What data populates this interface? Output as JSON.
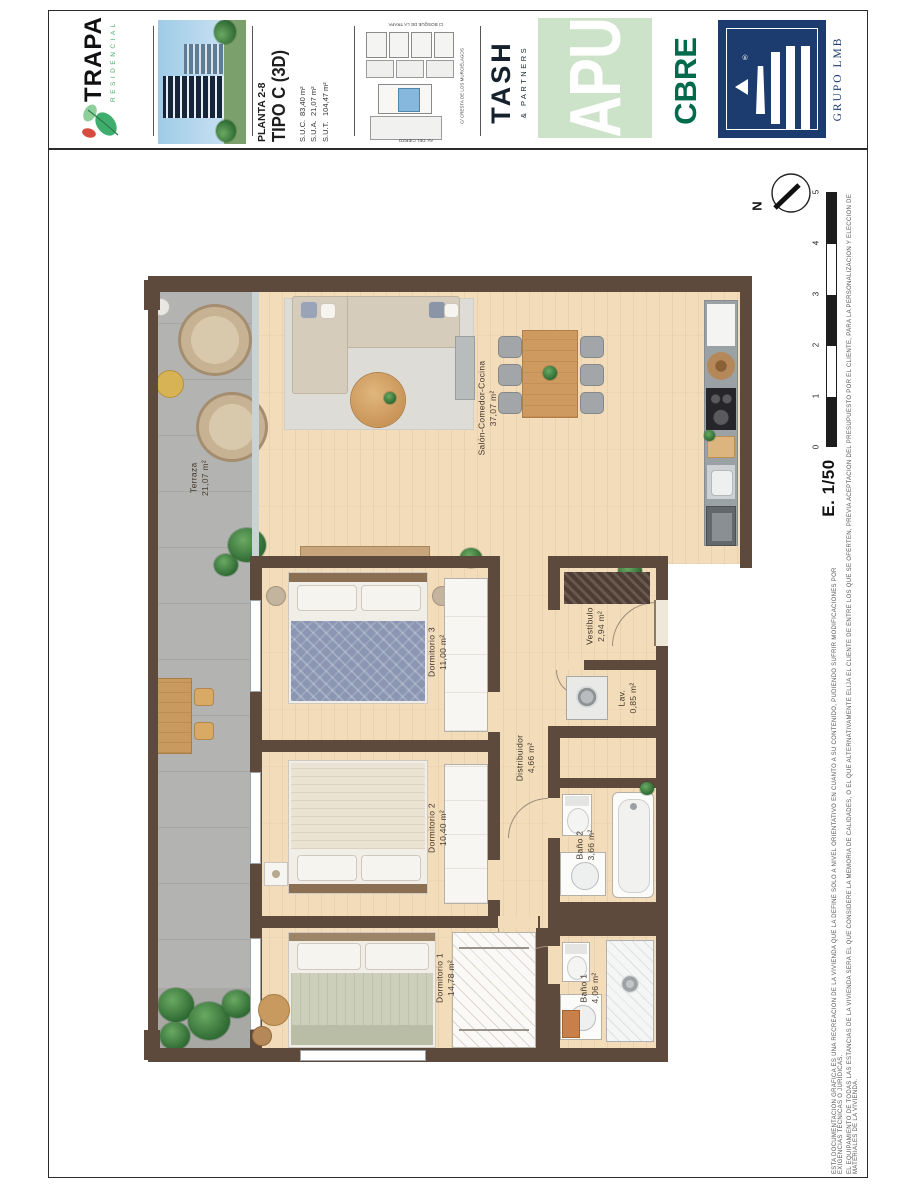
{
  "header": {
    "brand": {
      "name": "TRAPA",
      "sub": "RESIDENCIAL"
    },
    "plan": {
      "planta": "PLANTA 2-8",
      "tipo": "TIPO C (3D)",
      "suc_l": "S.U.C.",
      "suc_v": "83,40 m²",
      "sua_l": "S.U.A.",
      "sua_v": "21,07 m²",
      "sut_l": "S.U.T.",
      "sut_v": "104,47 m²"
    },
    "map": {
      "street_top": "C/ BOSQUE DE LA TRAPA",
      "street_right": "C/ CRESTA DE LOS MURCIÉLAGOS",
      "street_bottom": "AV. DEL CIERZO"
    },
    "partners": {
      "tash": "TASH",
      "tash_sub": "& PARTNERS",
      "apu": "APU",
      "cbre": "CBRE",
      "lmb": "GRUPO LMB",
      "lmb_r": "®"
    }
  },
  "rooms": [
    {
      "name": "Salón-Comedor-Cocina",
      "area": "37,07 m²"
    },
    {
      "name": "Terraza",
      "area": "21,07 m²"
    },
    {
      "name": "Dormitorio 3",
      "area": "11,00 m²"
    },
    {
      "name": "Vestíbulo",
      "area": "2,94 m²"
    },
    {
      "name": "Lav.",
      "area": "0,85 m²"
    },
    {
      "name": "Distribuidor",
      "area": "4,66 m²"
    },
    {
      "name": "Dormitorio 2",
      "area": "10,40 m²"
    },
    {
      "name": "Baño 2",
      "area": "3,66 m²"
    },
    {
      "name": "Dormitorio 1",
      "area": "14,78 m²"
    },
    {
      "name": "Baño 1",
      "area": "4,06 m²"
    }
  ],
  "compass": {
    "n": "N"
  },
  "scalebar": {
    "label": "E. 1/50",
    "ticks": [
      "0",
      "1",
      "2",
      "3",
      "4",
      "5"
    ]
  },
  "disclaimer": {
    "line1": "ESTA DOCUMENTACIÓN GRÁFICA ES UNA RECREACIÓN DE LA VIVIENDA QUE LA DEFINE SÓLO A NIVEL ORIENTATIVO EN CUANTO A SU CONTENIDO, PUDIENDO SUFRIR MODIFICACIONES POR EXIGENCIAS TÉCNICAS O JURÍDICAS.",
    "line2": "EL EQUIPAMIENTO DE TODAS LAS ESTANCIAS DE LA VIVIENDA SERÁ EL QUE CONSIDERE LA MEMORIA DE CALIDADES, O EL QUE ALTERNATIVAMENTE ELIJA EL CLIENTE DE ENTRE LOS QUE SE OFERTEN, PREVIA ACEPTACIÓN DEL PRESUPUESTO POR EL CLIENTE, PARA LA PERSONALIZACIÓN Y ELECCIÓN DE MATERIALES DE LA VIVIENDA."
  },
  "colors": {
    "wall_brown": "#5d4a3c",
    "wood_floor": "#f2dcba",
    "terrace_grey": "#b3b3b1",
    "apu_green": "#cde3c9",
    "cbre_green": "#006a4d",
    "lmb_navy": "#1c3b6e",
    "trapa_green": "#3fae6d",
    "highlight_blue": "#86b7dc"
  }
}
